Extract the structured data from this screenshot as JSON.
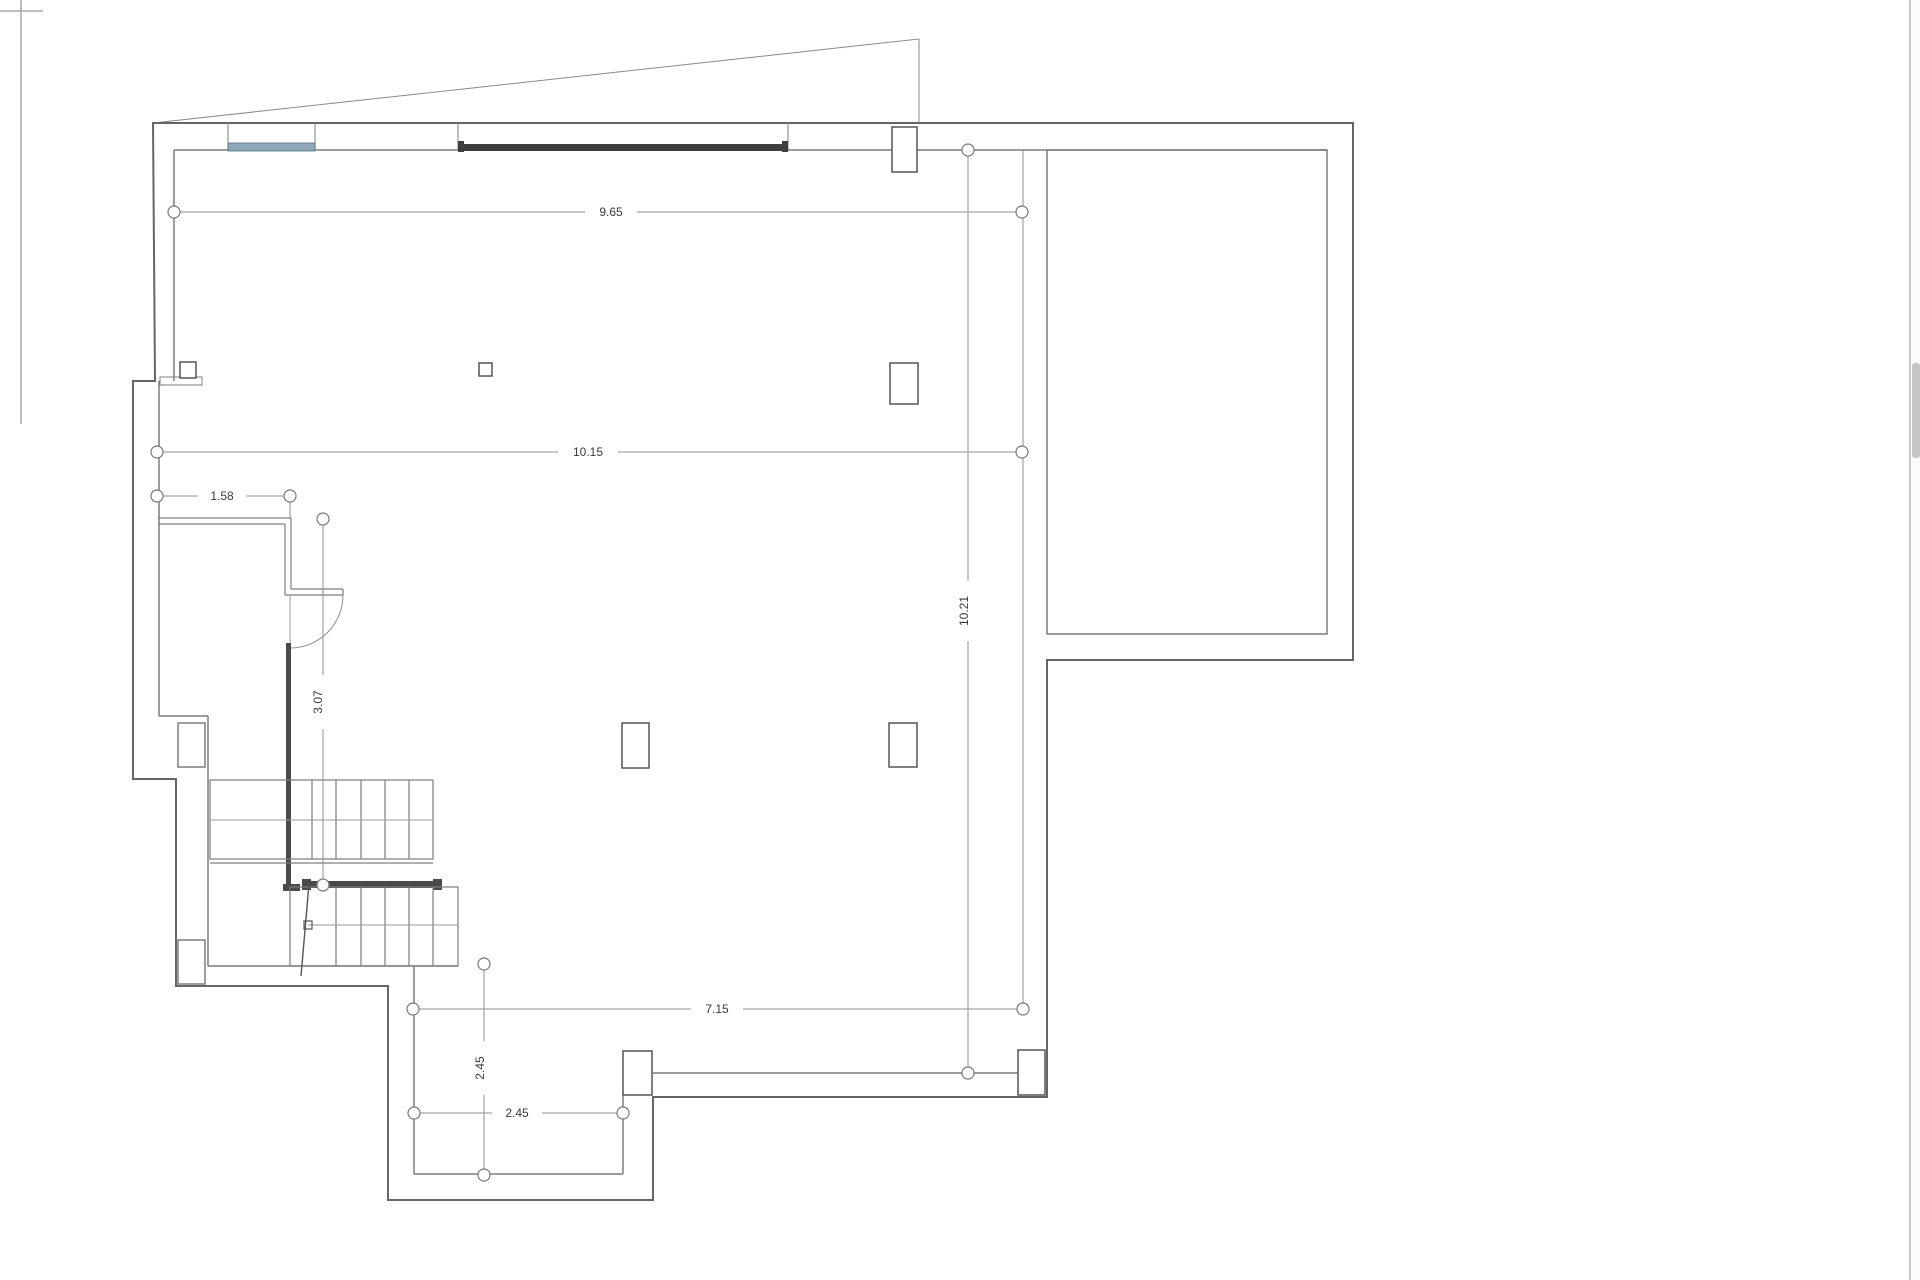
{
  "drawing": {
    "type": "architectural-floor-plan",
    "view": "basement / ground floor plan with staircase and pool room",
    "units": "m"
  },
  "dimensions": {
    "width_top": "9.65",
    "width_mid": "10.15",
    "width_left_room": "1.58",
    "height_right": "10.21",
    "height_stair": "3.07",
    "width_bottom": "7.15",
    "height_porch": "2.45",
    "width_porch": "2.45"
  },
  "colors": {
    "wall_line": "#666666",
    "thin_line": "#7d7d7d",
    "dim_line": "#8f8f8f",
    "label_text": "#3a3a3a",
    "window_glass": "#8ea7b8",
    "window_glass_edge": "#52707f",
    "window_dark": "#3f3f3f",
    "solid_wall": "#4a4a4a",
    "frame_line": "#a8a8a8",
    "scrollbar_thumb": "#c6c6c6"
  }
}
